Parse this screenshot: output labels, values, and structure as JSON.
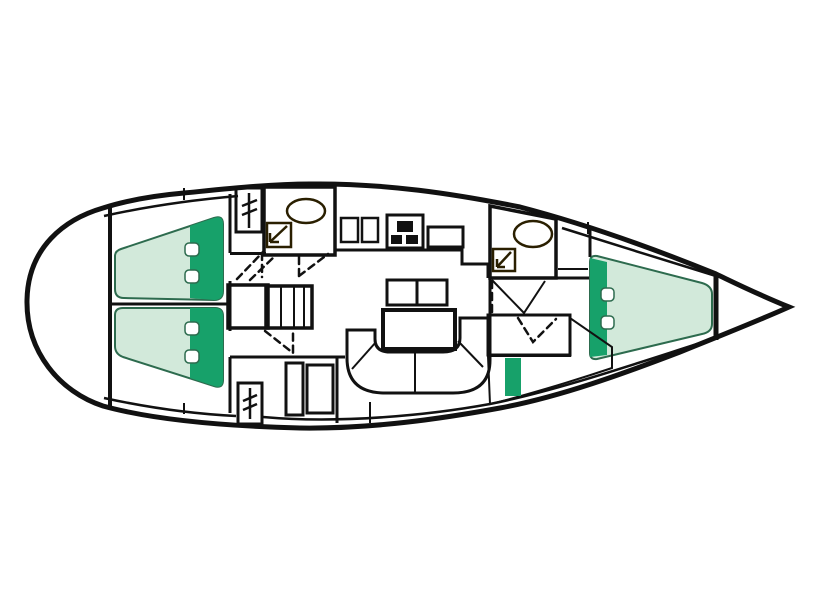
{
  "meta": {
    "diagram_type": "sailing-yacht-interior-floorplan",
    "view": "top-down deck plan",
    "orientation": "bow-right-stern-left",
    "visible_text": ""
  },
  "colors": {
    "background": "#ffffff",
    "floor": "#ffffff",
    "line": "#111111",
    "fixture_line": "#2a1f00",
    "berth": "#d2e9da",
    "pillow": "#17a16a",
    "berth_stroke": "#2d6b4e",
    "head": "#ecb766",
    "wardrobe": "#f6efc7",
    "wood": "#a87c3e",
    "steps": "#9d9d9d"
  },
  "rooms": [
    {
      "id": "stern-lazarette",
      "furniture": []
    },
    {
      "id": "aft-cabin-port",
      "furniture": [
        "double-berth",
        "pillow"
      ]
    },
    {
      "id": "aft-cabin-starboard",
      "furniture": [
        "double-berth",
        "pillow"
      ]
    },
    {
      "id": "aft-head",
      "furniture": [
        "washbasin",
        "shower"
      ]
    },
    {
      "id": "galley",
      "furniture": [
        "twin-sinks",
        "stove-three-burners",
        "oven-counter"
      ]
    },
    {
      "id": "saloon",
      "furniture": [
        "u-shaped-settee",
        "table",
        "sideboard-bench",
        "locker",
        "companionway-steps",
        "chart-table"
      ]
    },
    {
      "id": "forward-head",
      "furniture": [
        "washbasin",
        "shower"
      ]
    },
    {
      "id": "forward-cabin",
      "furniture": [
        "v-berth",
        "pillow",
        "seat-berth"
      ]
    },
    {
      "id": "bow-anchor-locker",
      "furniture": []
    }
  ],
  "icons": [
    {
      "id": "hanging-locker-icon",
      "meaning": "wardrobe with clothes rail"
    },
    {
      "id": "shower-icon",
      "meaning": "shower tray"
    },
    {
      "id": "burner-icon",
      "meaning": "stove burners"
    },
    {
      "id": "washbasin-icon",
      "meaning": "oval basin"
    }
  ]
}
